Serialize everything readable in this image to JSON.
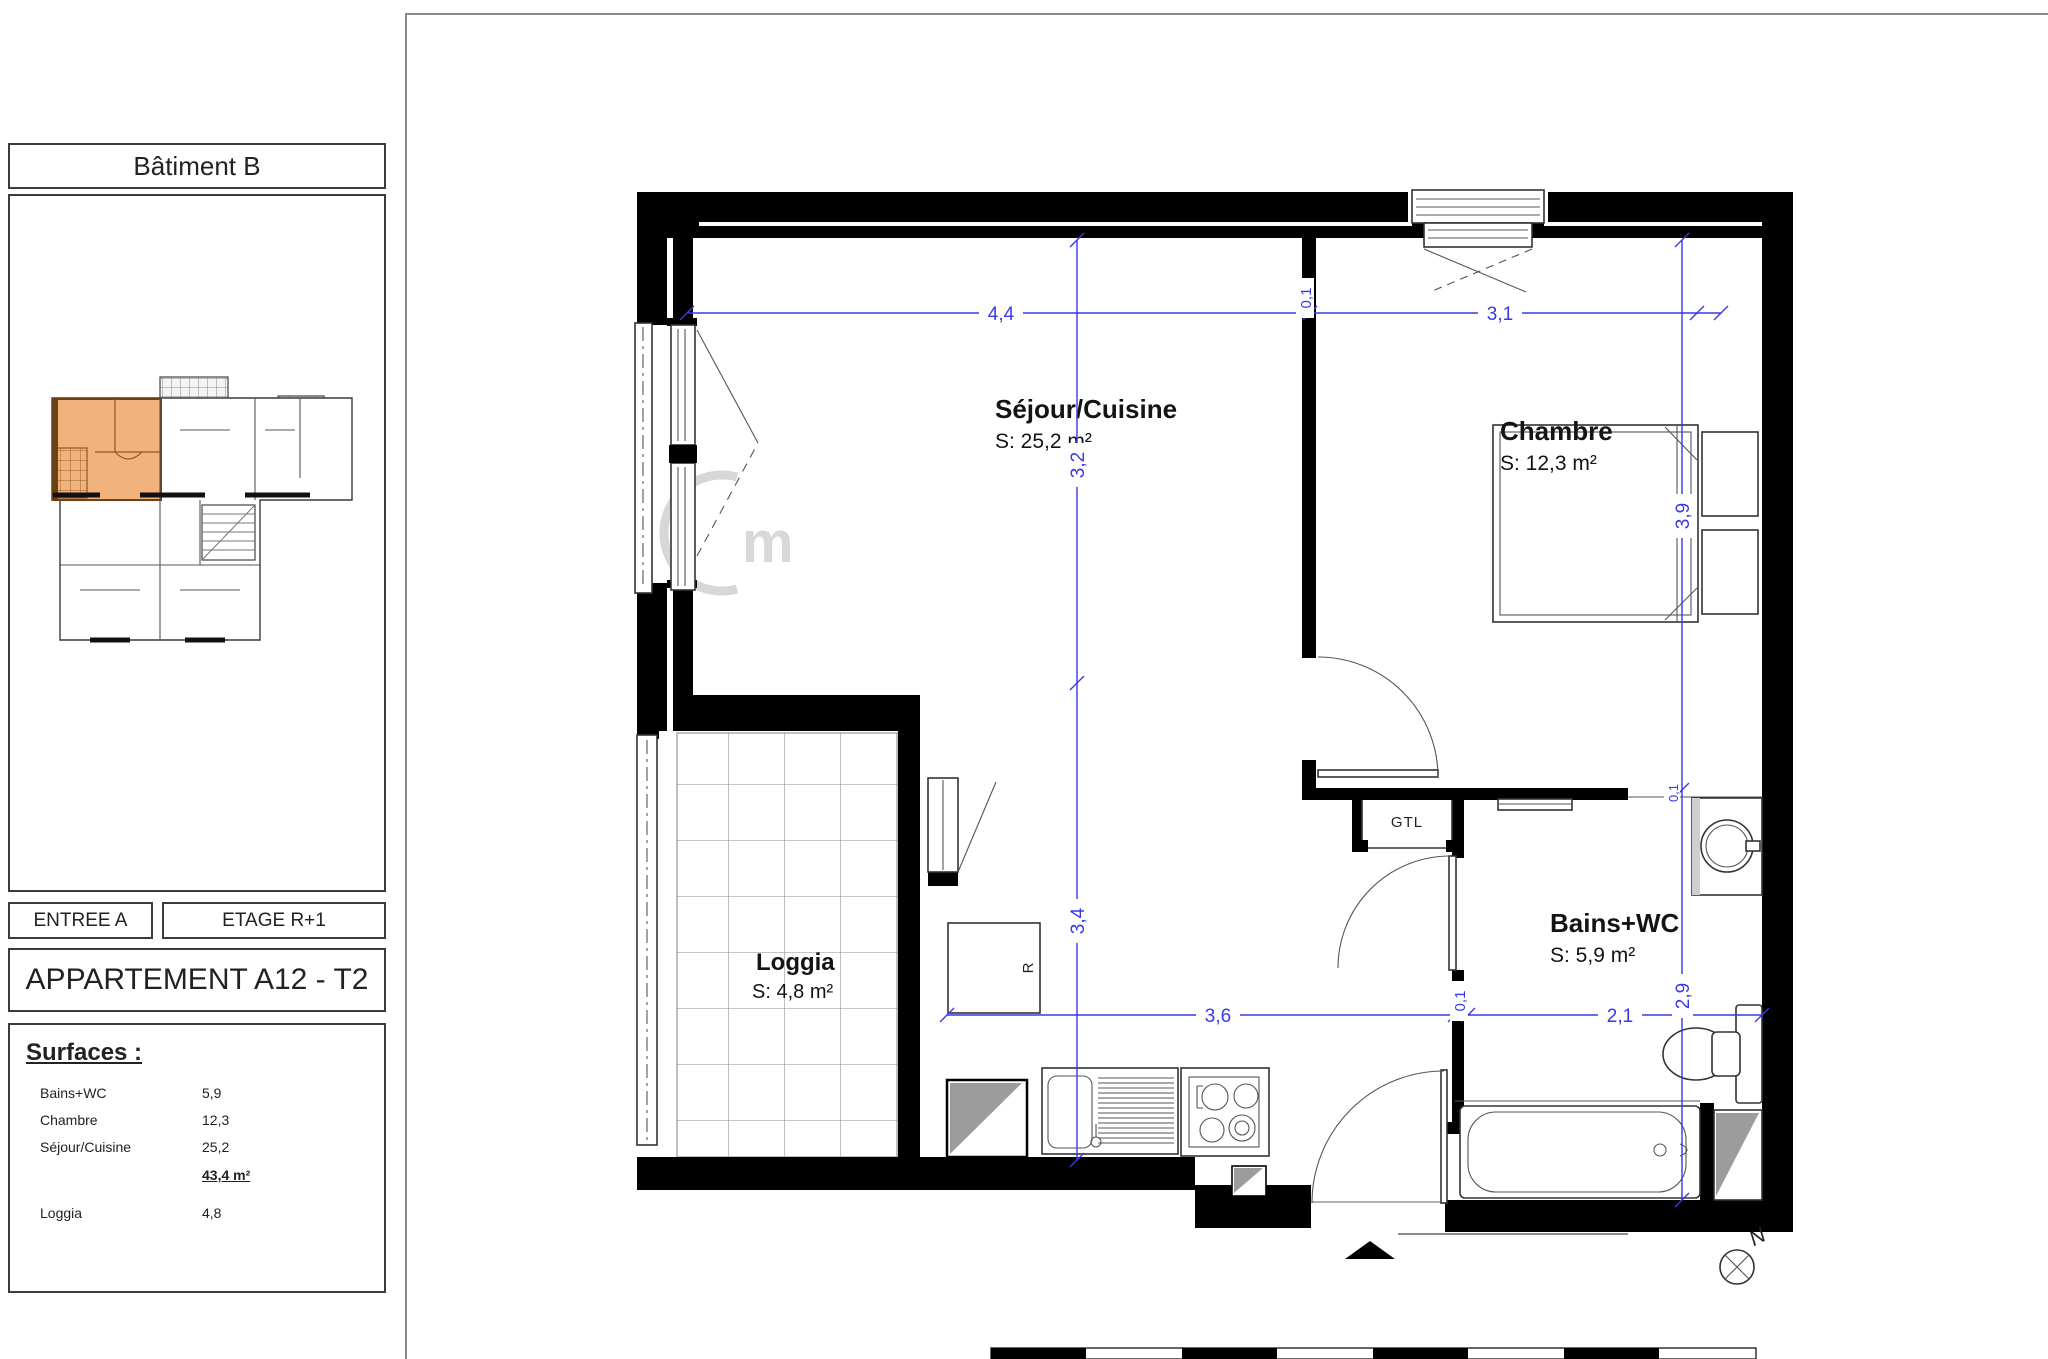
{
  "sidebar": {
    "building_title": "Bâtiment B",
    "entree": "ENTREE A",
    "etage": "ETAGE R+1",
    "apartment_title": "APPARTEMENT A12 - T2",
    "surfaces": {
      "title": "Surfaces :",
      "rows": [
        {
          "label": "Bains+WC",
          "value": "5,9"
        },
        {
          "label": "Chambre",
          "value": "12,3"
        },
        {
          "label": "Séjour/Cuisine",
          "value": "25,2"
        },
        {
          "label": "Loggia",
          "value": "4,8"
        }
      ],
      "total": "43,4 m²"
    }
  },
  "plan": {
    "rooms": [
      {
        "name": "Séjour/Cuisine",
        "area": "S: 25,2 m²"
      },
      {
        "name": "Chambre",
        "area": "S: 12,3 m²"
      },
      {
        "name": "Bains+WC",
        "area": "S: 5,9 m²"
      },
      {
        "name": "Loggia",
        "area": "S: 4,8 m²"
      }
    ],
    "labels": {
      "gtl": "GTL",
      "fridge": "R",
      "north": "N",
      "watermark": "m"
    },
    "dims": {
      "d44": "4,4",
      "d31": "3,1",
      "d32": "3,2",
      "d34": "3,4",
      "d39": "3,9",
      "d29": "2,9",
      "d36": "3,6",
      "d21": "2,1",
      "d01a": "0,1",
      "d01b": "0,1",
      "d01c": "0,1"
    }
  },
  "colors": {
    "dimension_blue": "#3939e8",
    "highlight_orange": "#f2b27b",
    "wall_black": "#000000",
    "duct_gray": "#9c9c9c"
  }
}
